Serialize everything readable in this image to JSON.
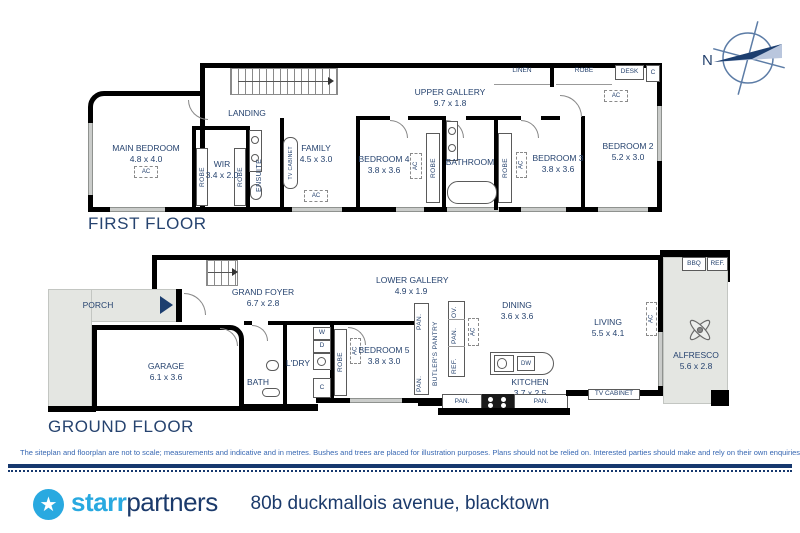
{
  "compass": {
    "north": "N"
  },
  "labels": {
    "robe": "ROBE",
    "ac": "AC",
    "pan": "PAN.",
    "ov": "OV.",
    "ref": "REF.",
    "dw": "DW",
    "bbq": "BBQ",
    "desk": "DESK",
    "c": "C",
    "linen": "LINEN",
    "tv_cabinet": "TV CABINET",
    "w": "W",
    "d": "D"
  },
  "first_floor": {
    "title": "FIRST FLOOR",
    "rooms": {
      "main_bedroom": {
        "name": "MAIN BEDROOM",
        "dims": "4.8 x 4.0"
      },
      "wir": {
        "name": "WIR",
        "dims": "3.4 x 2.0"
      },
      "ensuite": {
        "name": "ENSUITE"
      },
      "landing": {
        "name": "LANDING"
      },
      "family": {
        "name": "FAMILY",
        "dims": "4.5 x 3.0"
      },
      "bedroom4": {
        "name": "BEDROOM 4",
        "dims": "3.8 x 3.6"
      },
      "bathroom": {
        "name": "BATHROOM"
      },
      "bedroom3": {
        "name": "BEDROOM 3",
        "dims": "3.8 x 3.6"
      },
      "bedroom2": {
        "name": "BEDROOM 2",
        "dims": "5.2 x 3.0"
      },
      "upper_gallery": {
        "name": "UPPER GALLERY",
        "dims": "9.7 x 1.8"
      }
    }
  },
  "ground_floor": {
    "title": "GROUND FLOOR",
    "rooms": {
      "porch": {
        "name": "PORCH"
      },
      "garage": {
        "name": "GARAGE",
        "dims": "6.1 x 3.6"
      },
      "grand_foyer": {
        "name": "GRAND FOYER",
        "dims": "6.7 x 2.8"
      },
      "bath": {
        "name": "BATH"
      },
      "ldry": {
        "name": "L'DRY"
      },
      "bedroom5": {
        "name": "BEDROOM 5",
        "dims": "3.8 x 3.0"
      },
      "lower_gallery": {
        "name": "LOWER GALLERY",
        "dims": "4.9 x 1.9"
      },
      "butlers_pantry": {
        "name": "BUTLER'S PANTRY"
      },
      "dining": {
        "name": "DINING",
        "dims": "3.6 x 3.6"
      },
      "kitchen": {
        "name": "KITCHEN",
        "dims": "3.7 x 2.5"
      },
      "living": {
        "name": "LIVING",
        "dims": "5.5 x 4.1"
      },
      "alfresco": {
        "name": "ALFRESCO",
        "dims": "5.6 x 2.8"
      }
    }
  },
  "footer": {
    "disclaimer": "The siteplan and floorplan are not to scale; measurements and indicative and in metres. Bushes and trees are placed for illustration purposes. Plans should not be relied on. Interested parties should make and rely on their own enquiries.",
    "brand": {
      "star_glyph": "★",
      "starr": "starr",
      "partners": "partners"
    },
    "address": "80b duckmallois avenue, blacktown"
  },
  "colors": {
    "navy": "#1b3a6b",
    "light_blue": "#29a9e0",
    "wall": "#000000",
    "shade": "#e4e6e2"
  }
}
